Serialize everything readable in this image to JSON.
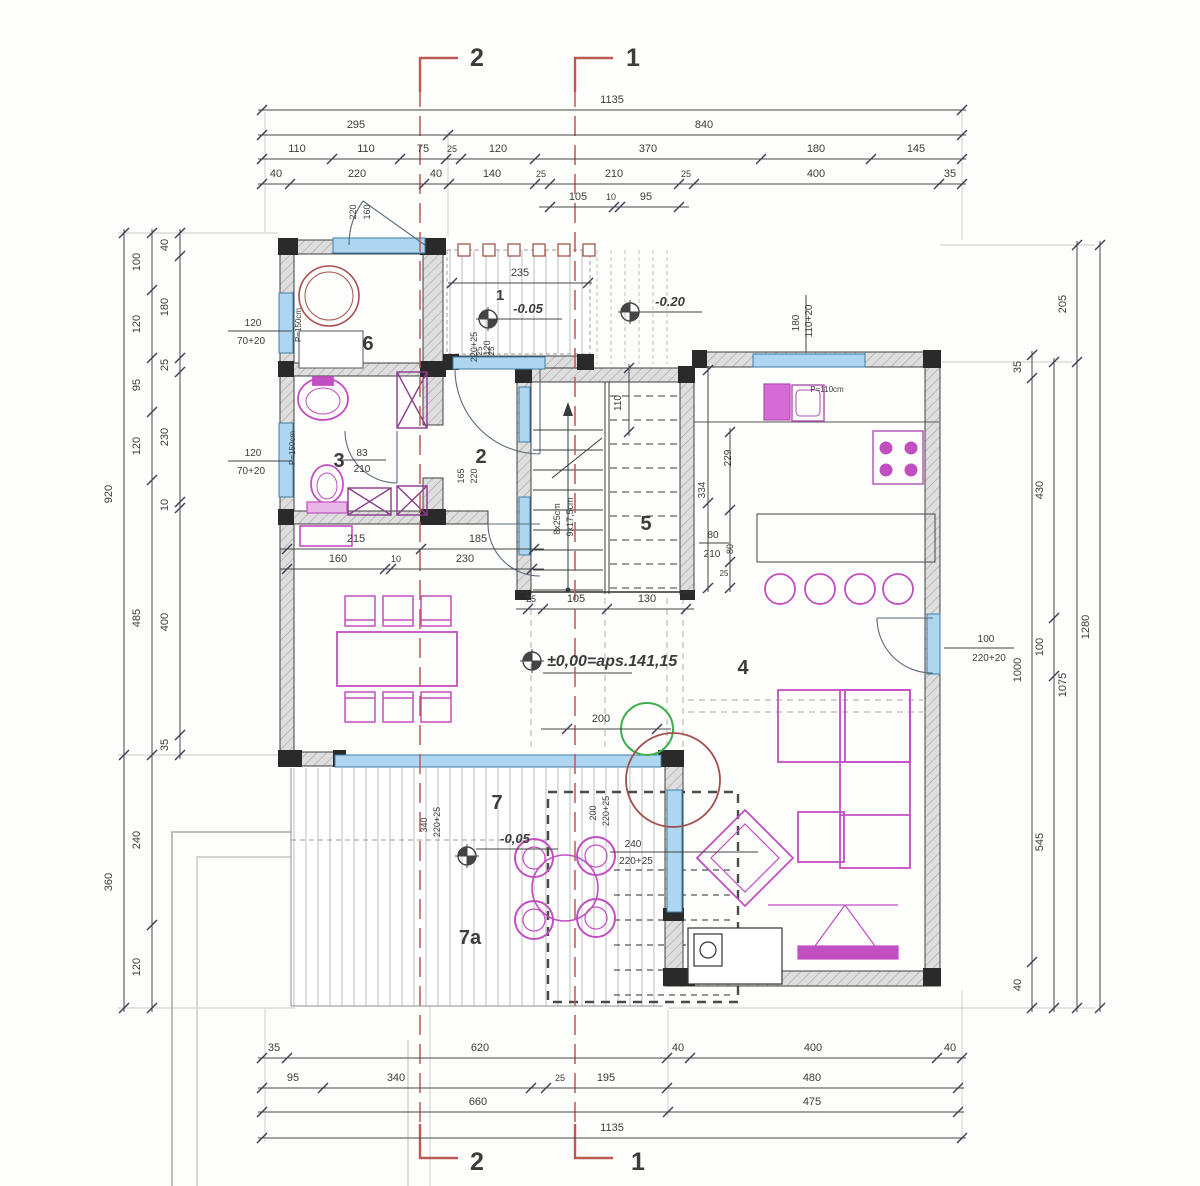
{
  "drawing_title": "floor-plan-ground-floor",
  "section_labels": [
    {
      "n": "section-label-2-top",
      "t": "2",
      "x": 477,
      "y": 66,
      "s": 25,
      "b": 1
    },
    {
      "n": "section-label-1-top",
      "t": "1",
      "x": 633,
      "y": 66,
      "s": 25,
      "b": 1
    },
    {
      "n": "section-label-2-bottom",
      "t": "2",
      "x": 477,
      "y": 1170,
      "s": 25,
      "b": 1
    },
    {
      "n": "section-label-1-bottom",
      "t": "1",
      "x": 638,
      "y": 1170,
      "s": 25,
      "b": 1
    }
  ],
  "room_labels": [
    {
      "n": "room-label-6",
      "t": "6",
      "x": 368,
      "y": 350,
      "s": 20,
      "b": 1
    },
    {
      "n": "room-label-3",
      "t": "3",
      "x": 339,
      "y": 467,
      "s": 20,
      "b": 1
    },
    {
      "n": "room-label-2",
      "t": "2",
      "x": 481,
      "y": 463,
      "s": 20,
      "b": 1
    },
    {
      "n": "room-label-5",
      "t": "5",
      "x": 646,
      "y": 530,
      "s": 20,
      "b": 1
    },
    {
      "n": "room-label-4",
      "t": "4",
      "x": 743,
      "y": 674,
      "s": 20,
      "b": 1
    },
    {
      "n": "room-label-7",
      "t": "7",
      "x": 497,
      "y": 809,
      "s": 20,
      "b": 1
    },
    {
      "n": "room-label-7a",
      "t": "7a",
      "x": 470,
      "y": 944,
      "s": 20,
      "b": 1
    },
    {
      "n": "porch-label-1",
      "t": "1",
      "x": 500,
      "y": 300,
      "s": 15,
      "b": 1
    }
  ],
  "level_labels": [
    {
      "n": "level-porch",
      "t": "-0.05",
      "x": 528,
      "y": 313,
      "s": 13,
      "b": 1,
      "i": 1
    },
    {
      "n": "level-ground",
      "t": "-0.20",
      "x": 670,
      "y": 306,
      "s": 13,
      "b": 1,
      "i": 1
    },
    {
      "n": "level-main",
      "t": "±0,00=aps.141,15",
      "x": 547,
      "y": 666,
      "s": 16,
      "b": 1,
      "i": 1,
      "a": "start"
    },
    {
      "n": "level-terrace",
      "t": "-0,05",
      "x": 515,
      "y": 843,
      "s": 13,
      "b": 1,
      "i": 1
    }
  ],
  "spec_labels": [
    {
      "n": "window-spec-left-top",
      "t": "120",
      "x": 253,
      "y": 326,
      "s": 10
    },
    {
      "n": "window-spec-left-top2",
      "t": "70+20",
      "x": 251,
      "y": 344,
      "s": 10
    },
    {
      "n": "window-spec-left-bot",
      "t": "120",
      "x": 253,
      "y": 456,
      "s": 10
    },
    {
      "n": "window-spec-left-bot2",
      "t": "70+20",
      "x": 251,
      "y": 474,
      "s": 10
    },
    {
      "n": "parapet-left-top",
      "t": "P=150cm",
      "x": 301,
      "y": 325,
      "s": 8,
      "r": -90
    },
    {
      "n": "parapet-left-bot",
      "t": "P=150cm",
      "x": 295,
      "y": 448,
      "s": 8,
      "r": -90
    },
    {
      "n": "door-spec-entry-a",
      "t": "220",
      "x": 356,
      "y": 212,
      "s": 9,
      "r": -90
    },
    {
      "n": "door-spec-entry-b",
      "t": "160",
      "x": 370,
      "y": 212,
      "s": 9,
      "r": -90
    },
    {
      "n": "door-spec-porch-a",
      "t": "220+25",
      "x": 477,
      "y": 347,
      "s": 9,
      "r": -90
    },
    {
      "n": "door-spec-porch-b",
      "t": "120",
      "x": 490,
      "y": 348,
      "s": 9,
      "r": -90
    },
    {
      "n": "window-spec-kitchen-a",
      "t": "180",
      "x": 799,
      "y": 323,
      "s": 10,
      "r": -90
    },
    {
      "n": "window-spec-kitchen-b",
      "t": "110+20",
      "x": 812,
      "y": 321,
      "s": 10,
      "r": -90
    },
    {
      "n": "parapet-kitchen",
      "t": "P=110cm",
      "x": 827,
      "y": 392,
      "s": 8
    },
    {
      "n": "door-spec-east-a",
      "t": "100",
      "x": 986,
      "y": 642,
      "s": 10
    },
    {
      "n": "door-spec-east-b",
      "t": "220+20",
      "x": 989,
      "y": 661,
      "s": 10
    },
    {
      "n": "door-spec-bath-a",
      "t": "83",
      "x": 362,
      "y": 456,
      "s": 10
    },
    {
      "n": "door-spec-bath-b",
      "t": "210",
      "x": 362,
      "y": 472,
      "s": 10
    },
    {
      "n": "opening-spec-hall-a",
      "t": "165",
      "x": 464,
      "y": 476,
      "s": 9,
      "r": -90
    },
    {
      "n": "opening-spec-hall-b",
      "t": "220",
      "x": 477,
      "y": 476,
      "s": 9,
      "r": -90
    },
    {
      "n": "stair-note-a",
      "t": "8x25cm",
      "x": 560,
      "y": 519,
      "s": 9,
      "r": -90
    },
    {
      "n": "stair-note-b",
      "t": "9x17,5cm",
      "x": 573,
      "y": 517,
      "s": 9,
      "r": -90
    },
    {
      "n": "door-spec-terrace-s-a",
      "t": "200",
      "x": 596,
      "y": 813,
      "s": 9,
      "r": -90
    },
    {
      "n": "door-spec-terrace-s-b",
      "t": "220+25",
      "x": 609,
      "y": 811,
      "s": 9,
      "r": -90
    },
    {
      "n": "door-spec-terrace-e-a",
      "t": "240",
      "x": 633,
      "y": 847,
      "s": 10
    },
    {
      "n": "door-spec-terrace-e-b",
      "t": "220+25",
      "x": 636,
      "y": 864,
      "s": 10
    },
    {
      "n": "window-spec-south-a",
      "t": "340",
      "x": 427,
      "y": 825,
      "s": 9,
      "r": -90
    },
    {
      "n": "window-spec-south-b",
      "t": "220+25",
      "x": 440,
      "y": 822,
      "s": 9,
      "r": -90
    },
    {
      "n": "dim-stair-110",
      "t": "110",
      "x": 621,
      "y": 403,
      "s": 10,
      "r": -90
    },
    {
      "n": "dim-229",
      "t": "229",
      "x": 731,
      "y": 458,
      "s": 10,
      "r": -90
    },
    {
      "n": "dim-334",
      "t": "334",
      "x": 705,
      "y": 490,
      "s": 10,
      "r": -90
    },
    {
      "n": "dim-80a",
      "t": "80",
      "x": 713,
      "y": 538,
      "s": 10
    },
    {
      "n": "dim-210",
      "t": "210",
      "x": 712,
      "y": 557,
      "s": 10
    },
    {
      "n": "dim-80b",
      "t": "80",
      "x": 733,
      "y": 549,
      "s": 9,
      "r": -90
    },
    {
      "n": "dim-25a",
      "t": "25",
      "x": 724,
      "y": 576,
      "s": 8
    },
    {
      "n": "dim-25-porch-a",
      "t": "25",
      "x": 482,
      "y": 351,
      "s": 8,
      "r": -90
    },
    {
      "n": "dim-25-porch-b",
      "t": "25",
      "x": 494,
      "y": 351,
      "s": 8,
      "r": -90
    }
  ],
  "dim_chains": [
    {
      "n": "top-row-total",
      "o": "h",
      "p": 110,
      "f": 262,
      "e": 962,
      "k": [
        262,
        962
      ],
      "L": [
        {
          "t": "1135",
          "x": 612,
          "y": 103
        }
      ]
    },
    {
      "n": "top-row-2",
      "o": "h",
      "p": 135,
      "f": 262,
      "e": 962,
      "k": [
        262,
        448,
        962
      ],
      "L": [
        {
          "t": "295",
          "x": 356,
          "y": 128
        },
        {
          "t": "840",
          "x": 704,
          "y": 128
        }
      ]
    },
    {
      "n": "top-row-3",
      "o": "h",
      "p": 159,
      "f": 262,
      "e": 962,
      "k": [
        262,
        332,
        400,
        446,
        461,
        535,
        761,
        871,
        962
      ],
      "L": [
        {
          "t": "110",
          "x": 297,
          "y": 152
        },
        {
          "t": "110",
          "x": 366,
          "y": 152
        },
        {
          "t": "75",
          "x": 423,
          "y": 152
        },
        {
          "t": "25",
          "x": 452,
          "y": 152,
          "s": 9
        },
        {
          "t": "120",
          "x": 498,
          "y": 152
        },
        {
          "t": "370",
          "x": 648,
          "y": 152
        },
        {
          "t": "180",
          "x": 816,
          "y": 152
        },
        {
          "t": "145",
          "x": 916,
          "y": 152
        }
      ]
    },
    {
      "n": "top-row-4",
      "o": "h",
      "p": 184,
      "f": 262,
      "e": 962,
      "k": [
        262,
        290,
        424,
        449,
        535,
        550,
        679,
        694,
        939,
        962
      ],
      "L": [
        {
          "t": "40",
          "x": 276,
          "y": 177
        },
        {
          "t": "220",
          "x": 357,
          "y": 177
        },
        {
          "t": "40",
          "x": 436,
          "y": 177
        },
        {
          "t": "140",
          "x": 492,
          "y": 177
        },
        {
          "t": "25",
          "x": 541,
          "y": 177,
          "s": 9
        },
        {
          "t": "210",
          "x": 614,
          "y": 177
        },
        {
          "t": "25",
          "x": 686,
          "y": 177,
          "s": 9
        },
        {
          "t": "400",
          "x": 816,
          "y": 177
        },
        {
          "t": "35",
          "x": 950,
          "y": 177
        }
      ]
    },
    {
      "n": "top-row-5",
      "o": "h",
      "p": 207,
      "f": 543,
      "e": 685,
      "k": [
        550,
        614,
        620,
        679
      ],
      "L": [
        {
          "t": "105",
          "x": 578,
          "y": 200
        },
        {
          "t": "10",
          "x": 611,
          "y": 200,
          "s": 9
        },
        {
          "t": "95",
          "x": 646,
          "y": 200
        }
      ]
    },
    {
      "n": "bottom-row-1",
      "o": "h",
      "p": 1058,
      "f": 262,
      "e": 962,
      "k": [
        262,
        287,
        667,
        690,
        937,
        962
      ],
      "L": [
        {
          "t": "35",
          "x": 274,
          "y": 1051
        },
        {
          "t": "620",
          "x": 480,
          "y": 1051
        },
        {
          "t": "40",
          "x": 678,
          "y": 1051
        },
        {
          "t": "400",
          "x": 813,
          "y": 1051
        },
        {
          "t": "40",
          "x": 950,
          "y": 1051
        }
      ]
    },
    {
      "n": "bottom-row-2",
      "o": "h",
      "p": 1088,
      "f": 262,
      "e": 960,
      "k": [
        262,
        323,
        531,
        546,
        667,
        958
      ],
      "L": [
        {
          "t": "95",
          "x": 293,
          "y": 1081
        },
        {
          "t": "340",
          "x": 396,
          "y": 1081
        },
        {
          "t": "25",
          "x": 560,
          "y": 1081,
          "s": 9
        },
        {
          "t": "195",
          "x": 606,
          "y": 1081
        },
        {
          "t": "480",
          "x": 812,
          "y": 1081
        }
      ]
    },
    {
      "n": "bottom-row-3",
      "o": "h",
      "p": 1112,
      "f": 262,
      "e": 960,
      "k": [
        262,
        668,
        958
      ],
      "L": [
        {
          "t": "660",
          "x": 478,
          "y": 1105
        },
        {
          "t": "475",
          "x": 812,
          "y": 1105
        }
      ]
    },
    {
      "n": "bottom-row-total",
      "o": "h",
      "p": 1138,
      "f": 262,
      "e": 962,
      "k": [
        262,
        962
      ],
      "L": [
        {
          "t": "1135",
          "x": 612,
          "y": 1131
        }
      ]
    },
    {
      "n": "left-col-outer",
      "o": "v",
      "p": 124,
      "f": 233,
      "e": 1008,
      "k": [
        233,
        755,
        1008
      ],
      "L": [
        {
          "t": "920",
          "x": 112,
          "y": 494
        },
        {
          "t": "360",
          "x": 112,
          "y": 882
        }
      ]
    },
    {
      "n": "left-col-mid",
      "o": "v",
      "p": 152,
      "f": 233,
      "e": 1008,
      "k": [
        233,
        290,
        358,
        412,
        480,
        755,
        925,
        1008
      ],
      "L": [
        {
          "t": "100",
          "x": 140,
          "y": 262
        },
        {
          "t": "120",
          "x": 140,
          "y": 324
        },
        {
          "t": "95",
          "x": 140,
          "y": 385
        },
        {
          "t": "120",
          "x": 140,
          "y": 446
        },
        {
          "t": "485",
          "x": 140,
          "y": 618
        },
        {
          "t": "240",
          "x": 140,
          "y": 840
        },
        {
          "t": "120",
          "x": 140,
          "y": 967
        }
      ]
    },
    {
      "n": "left-col-inner",
      "o": "v",
      "p": 180,
      "f": 233,
      "e": 755,
      "k": [
        233,
        256,
        358,
        372,
        502,
        508,
        735,
        755
      ],
      "L": [
        {
          "t": "40",
          "x": 168,
          "y": 245
        },
        {
          "t": "180",
          "x": 168,
          "y": 307
        },
        {
          "t": "25",
          "x": 168,
          "y": 365
        },
        {
          "t": "230",
          "x": 168,
          "y": 437
        },
        {
          "t": "10",
          "x": 168,
          "y": 505
        },
        {
          "t": "400",
          "x": 168,
          "y": 622
        },
        {
          "t": "35",
          "x": 168,
          "y": 745
        }
      ]
    },
    {
      "n": "right-col-a",
      "o": "v",
      "p": 1032,
      "f": 355,
      "e": 1008,
      "k": [
        355,
        378,
        962,
        1008
      ],
      "L": [
        {
          "t": "35",
          "x": 1021,
          "y": 367
        },
        {
          "t": "1000",
          "x": 1021,
          "y": 670
        },
        {
          "t": "40",
          "x": 1021,
          "y": 985
        }
      ]
    },
    {
      "n": "right-col-b",
      "o": "v",
      "p": 1054,
      "f": 362,
      "e": 1008,
      "k": [
        362,
        618,
        676,
        1008
      ],
      "L": [
        {
          "t": "430",
          "x": 1043,
          "y": 490
        },
        {
          "t": "100",
          "x": 1043,
          "y": 647
        },
        {
          "t": "545",
          "x": 1043,
          "y": 842
        }
      ]
    },
    {
      "n": "right-col-c",
      "o": "v",
      "p": 1077,
      "f": 245,
      "e": 1008,
      "k": [
        245,
        362,
        1008
      ],
      "L": [
        {
          "t": "205",
          "x": 1066,
          "y": 304
        },
        {
          "t": "1075",
          "x": 1066,
          "y": 685
        }
      ]
    },
    {
      "n": "right-col-d",
      "o": "v",
      "p": 1100,
      "f": 245,
      "e": 1008,
      "k": [
        245,
        1008
      ],
      "L": [
        {
          "t": "1280",
          "x": 1089,
          "y": 627
        }
      ]
    },
    {
      "n": "porch-235",
      "o": "h",
      "p": 283,
      "f": 452,
      "e": 588,
      "k": [
        452,
        588
      ],
      "L": [
        {
          "t": "235",
          "x": 520,
          "y": 276
        }
      ]
    },
    {
      "n": "stair-bottom",
      "o": "h",
      "p": 609,
      "f": 520,
      "e": 690,
      "k": [
        528,
        543,
        607,
        686
      ],
      "L": [
        {
          "t": "25",
          "x": 531,
          "y": 602,
          "s": 9
        },
        {
          "t": "105",
          "x": 576,
          "y": 602
        },
        {
          "t": "130",
          "x": 647,
          "y": 602
        }
      ]
    },
    {
      "n": "hall-upper",
      "o": "h",
      "p": 549,
      "f": 284,
      "e": 540,
      "k": [
        287,
        421,
        534
      ],
      "L": [
        {
          "t": "215",
          "x": 356,
          "y": 542
        },
        {
          "t": "185",
          "x": 478,
          "y": 542
        }
      ]
    },
    {
      "n": "hall-lower",
      "o": "h",
      "p": 569,
      "f": 284,
      "e": 540,
      "k": [
        287,
        385,
        391,
        532
      ],
      "L": [
        {
          "t": "160",
          "x": 338,
          "y": 562
        },
        {
          "t": "10",
          "x": 396,
          "y": 562,
          "s": 9
        },
        {
          "t": "230",
          "x": 465,
          "y": 562
        }
      ]
    },
    {
      "n": "living-200",
      "o": "h",
      "p": 729,
      "f": 545,
      "e": 667,
      "k": [
        567,
        657
      ],
      "L": [
        {
          "t": "200",
          "x": 601,
          "y": 722
        }
      ]
    },
    {
      "n": "stair-110",
      "o": "v",
      "p": 629,
      "f": 368,
      "e": 432,
      "k": [
        368,
        432
      ],
      "L": []
    },
    {
      "n": "stair-right-1",
      "o": "v",
      "p": 708,
      "f": 370,
      "e": 588,
      "k": [
        370,
        503,
        588
      ],
      "L": []
    },
    {
      "n": "stair-right-2",
      "o": "v",
      "p": 730,
      "f": 432,
      "e": 588,
      "k": [
        432,
        510,
        562,
        588
      ],
      "L": []
    }
  ],
  "colors": {
    "magenta": "#c24fc2",
    "blue_window": "#aed6f1",
    "section_red": "#bb5a52",
    "green": "#3fae4c",
    "dark_red": "#a34d4d",
    "wall": "#2e2e2e"
  }
}
